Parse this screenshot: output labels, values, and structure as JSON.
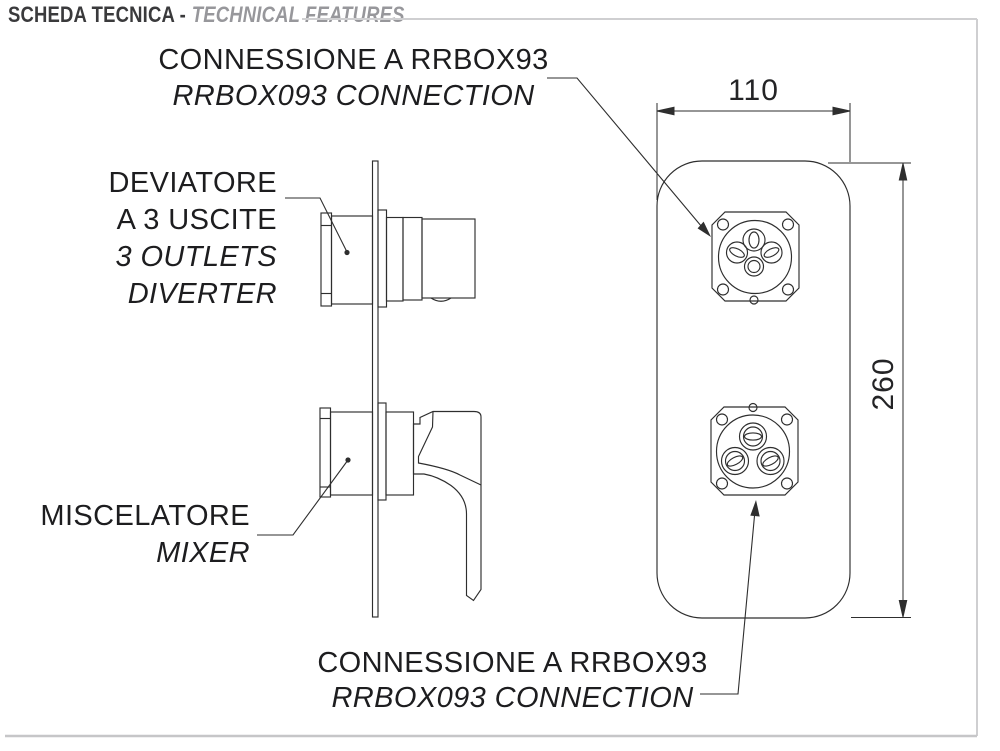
{
  "header": {
    "title_it": "SCHEDA TECNICA -",
    "title_en": "TECHNICAL FEATURES"
  },
  "labels": {
    "top_connection": {
      "line1": "CONNESSIONE A RRBOX93",
      "line2": "RRBOX093 CONNECTION"
    },
    "diverter": {
      "line1": "DEVIATORE",
      "line2": "A 3 USCITE",
      "line3": "3 OUTLETS",
      "line4": "DIVERTER"
    },
    "mixer": {
      "line1": "MISCELATORE",
      "line2": "MIXER"
    },
    "bottom_connection": {
      "line1": "CONNESSIONE A RRBOX93",
      "line2": "RRBOX093 CONNECTION"
    }
  },
  "dimensions": {
    "plate_width_mm": "110",
    "plate_height_mm": "260"
  },
  "colors": {
    "drawing_line": "#2e2e2e",
    "frame_line": "#cfcfd1",
    "title_dark": "#3a3a3c",
    "title_gray": "#97979b"
  }
}
